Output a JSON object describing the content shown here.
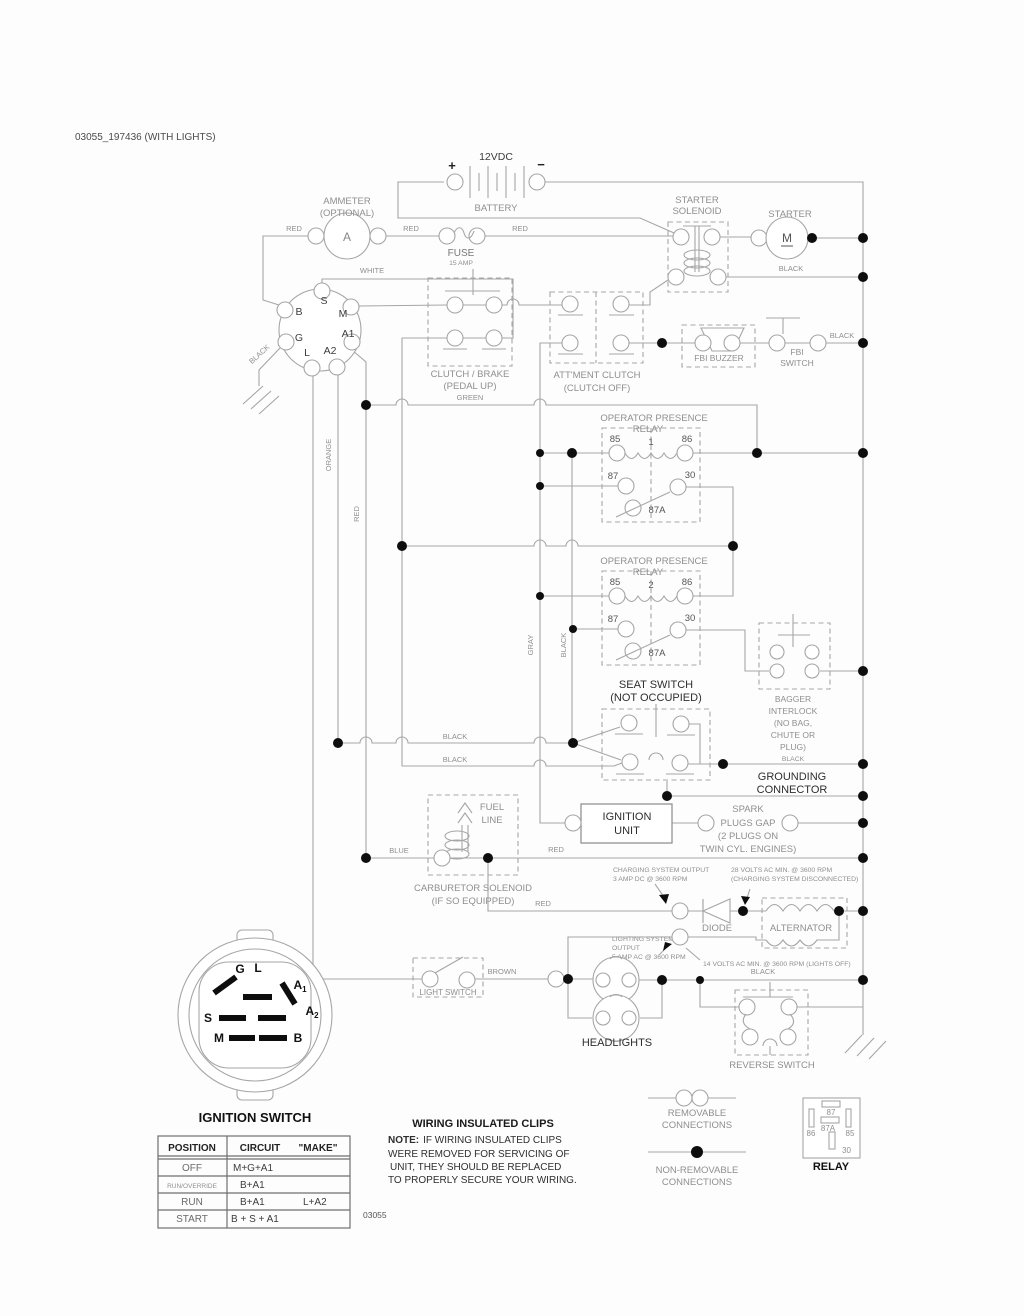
{
  "title": "03055_197436 (WITH LIGHTS)",
  "doc_code": "03055",
  "battery": {
    "plus": "+",
    "minus": "−",
    "voltage": "12VDC",
    "label": "BATTERY"
  },
  "ammeter": {
    "line1": "AMMETER",
    "line2": "(OPTIONAL)",
    "symbol": "A"
  },
  "fuse": {
    "label": "FUSE",
    "rating": "15 AMP"
  },
  "solenoid": {
    "line1": "STARTER",
    "line2": "SOLENOID"
  },
  "starter": {
    "label": "STARTER",
    "symbol": "M"
  },
  "keyswitch": {
    "s": "S",
    "m": "M",
    "b": "B",
    "g": "G",
    "l": "L",
    "a1": "A1",
    "a2": "A2"
  },
  "clutch_brake": {
    "line1": "CLUTCH / BRAKE",
    "line2": "(PEDAL UP)"
  },
  "attment": {
    "line1": "ATT'MENT CLUTCH",
    "line2": "(CLUTCH OFF)"
  },
  "fbi": {
    "buzzer": "FBI BUZZER",
    "switch1": "FBI",
    "switch2": "SWITCH"
  },
  "relay1": {
    "t1": "OPERATOR PRESENCE",
    "t2": "RELAY",
    "num": "1",
    "p85": "85",
    "p86": "86",
    "p87": "87",
    "p30": "30",
    "p87a": "87A"
  },
  "relay2": {
    "t1": "OPERATOR PRESENCE",
    "t2": "RELAY",
    "num": "2",
    "p85": "85",
    "p86": "86",
    "p87": "87",
    "p30": "30",
    "p87a": "87A"
  },
  "seat": {
    "line1": "SEAT SWITCH",
    "line2": "(NOT OCCUPIED)"
  },
  "bagger": {
    "line1": "BAGGER",
    "line2": "INTERLOCK",
    "line3": "(NO BAG,",
    "line4": "CHUTE OR",
    "line5": "PLUG)"
  },
  "grounding": {
    "line1": "GROUNDING",
    "line2": "CONNECTOR"
  },
  "ignition_unit": {
    "line1": "IGNITION",
    "line2": "UNIT"
  },
  "spark": {
    "line1": "SPARK",
    "line2": "PLUGS GAP",
    "line3": "(2 PLUGS ON",
    "line4": "TWIN CYL. ENGINES)"
  },
  "fuel": {
    "line1": "FUEL",
    "line2": "LINE"
  },
  "carb": {
    "line1": "CARBURETOR SOLENOID",
    "line2": "(IF SO EQUIPPED)"
  },
  "charging": {
    "out1": "CHARGING SYSTEM OUTPUT",
    "out2": "3 AMP DC @ 3600 RPM",
    "volts1": "28 VOLTS AC MIN. @ 3600 RPM",
    "volts2": "(CHARGING SYSTEM DISCONNECTED)"
  },
  "diode": "DIODE",
  "alternator": "ALTERNATOR",
  "lighting": {
    "out1": "LIGHTING SYSTEM",
    "out2": "OUTPUT",
    "out3": "5 AMP AC @ 3600 RPM",
    "volts": "14 VOLTS AC MIN. @ 3600 RPM (LIGHTS OFF)"
  },
  "light_switch": "LIGHT SWITCH",
  "headlights": "HEADLIGHTS",
  "reverse": "REVERSE SWITCH",
  "big_switch": {
    "title": "IGNITION SWITCH",
    "g": "G",
    "l": "L",
    "a": "A",
    "sub1": "1",
    "sub2": "2",
    "s": "S",
    "m": "M",
    "b": "B"
  },
  "wires": {
    "red": "RED",
    "white": "WHITE",
    "black": "BLACK",
    "green": "GREEN",
    "orange": "ORANGE",
    "gray": "GRAY",
    "blue": "BLUE",
    "brown": "BROWN"
  },
  "table": {
    "h1": "POSITION",
    "h2": "CIRCUIT",
    "h3": "\"MAKE\"",
    "rows": [
      [
        "OFF",
        "M+G+A1",
        ""
      ],
      [
        "RUN/OVERRIDE",
        "B+A1",
        ""
      ],
      [
        "RUN",
        "B+A1",
        "L+A2"
      ],
      [
        "START",
        "B + S + A1",
        ""
      ]
    ]
  },
  "clips": {
    "title": "WIRING INSULATED CLIPS",
    "note": "NOTE:",
    "l1": "IF WIRING INSULATED CLIPS",
    "l2": "WERE REMOVED FOR SERVICING OF",
    "l3": "UNIT, THEY SHOULD BE REPLACED",
    "l4": "TO PROPERLY SECURE YOUR WIRING."
  },
  "legend": {
    "rem1": "REMOVABLE",
    "rem2": "CONNECTIONS",
    "non1": "NON-REMOVABLE",
    "non2": "CONNECTIONS",
    "relay": {
      "label": "RELAY",
      "p87": "87",
      "p86": "86",
      "p87a": "87A",
      "p85": "85",
      "p30": "30"
    }
  },
  "colors": {
    "wire": "#a6a6a6",
    "label_gray": "#8f8f8f",
    "text_dark": "#2e2e2e",
    "dot": "#0e0e0e"
  }
}
